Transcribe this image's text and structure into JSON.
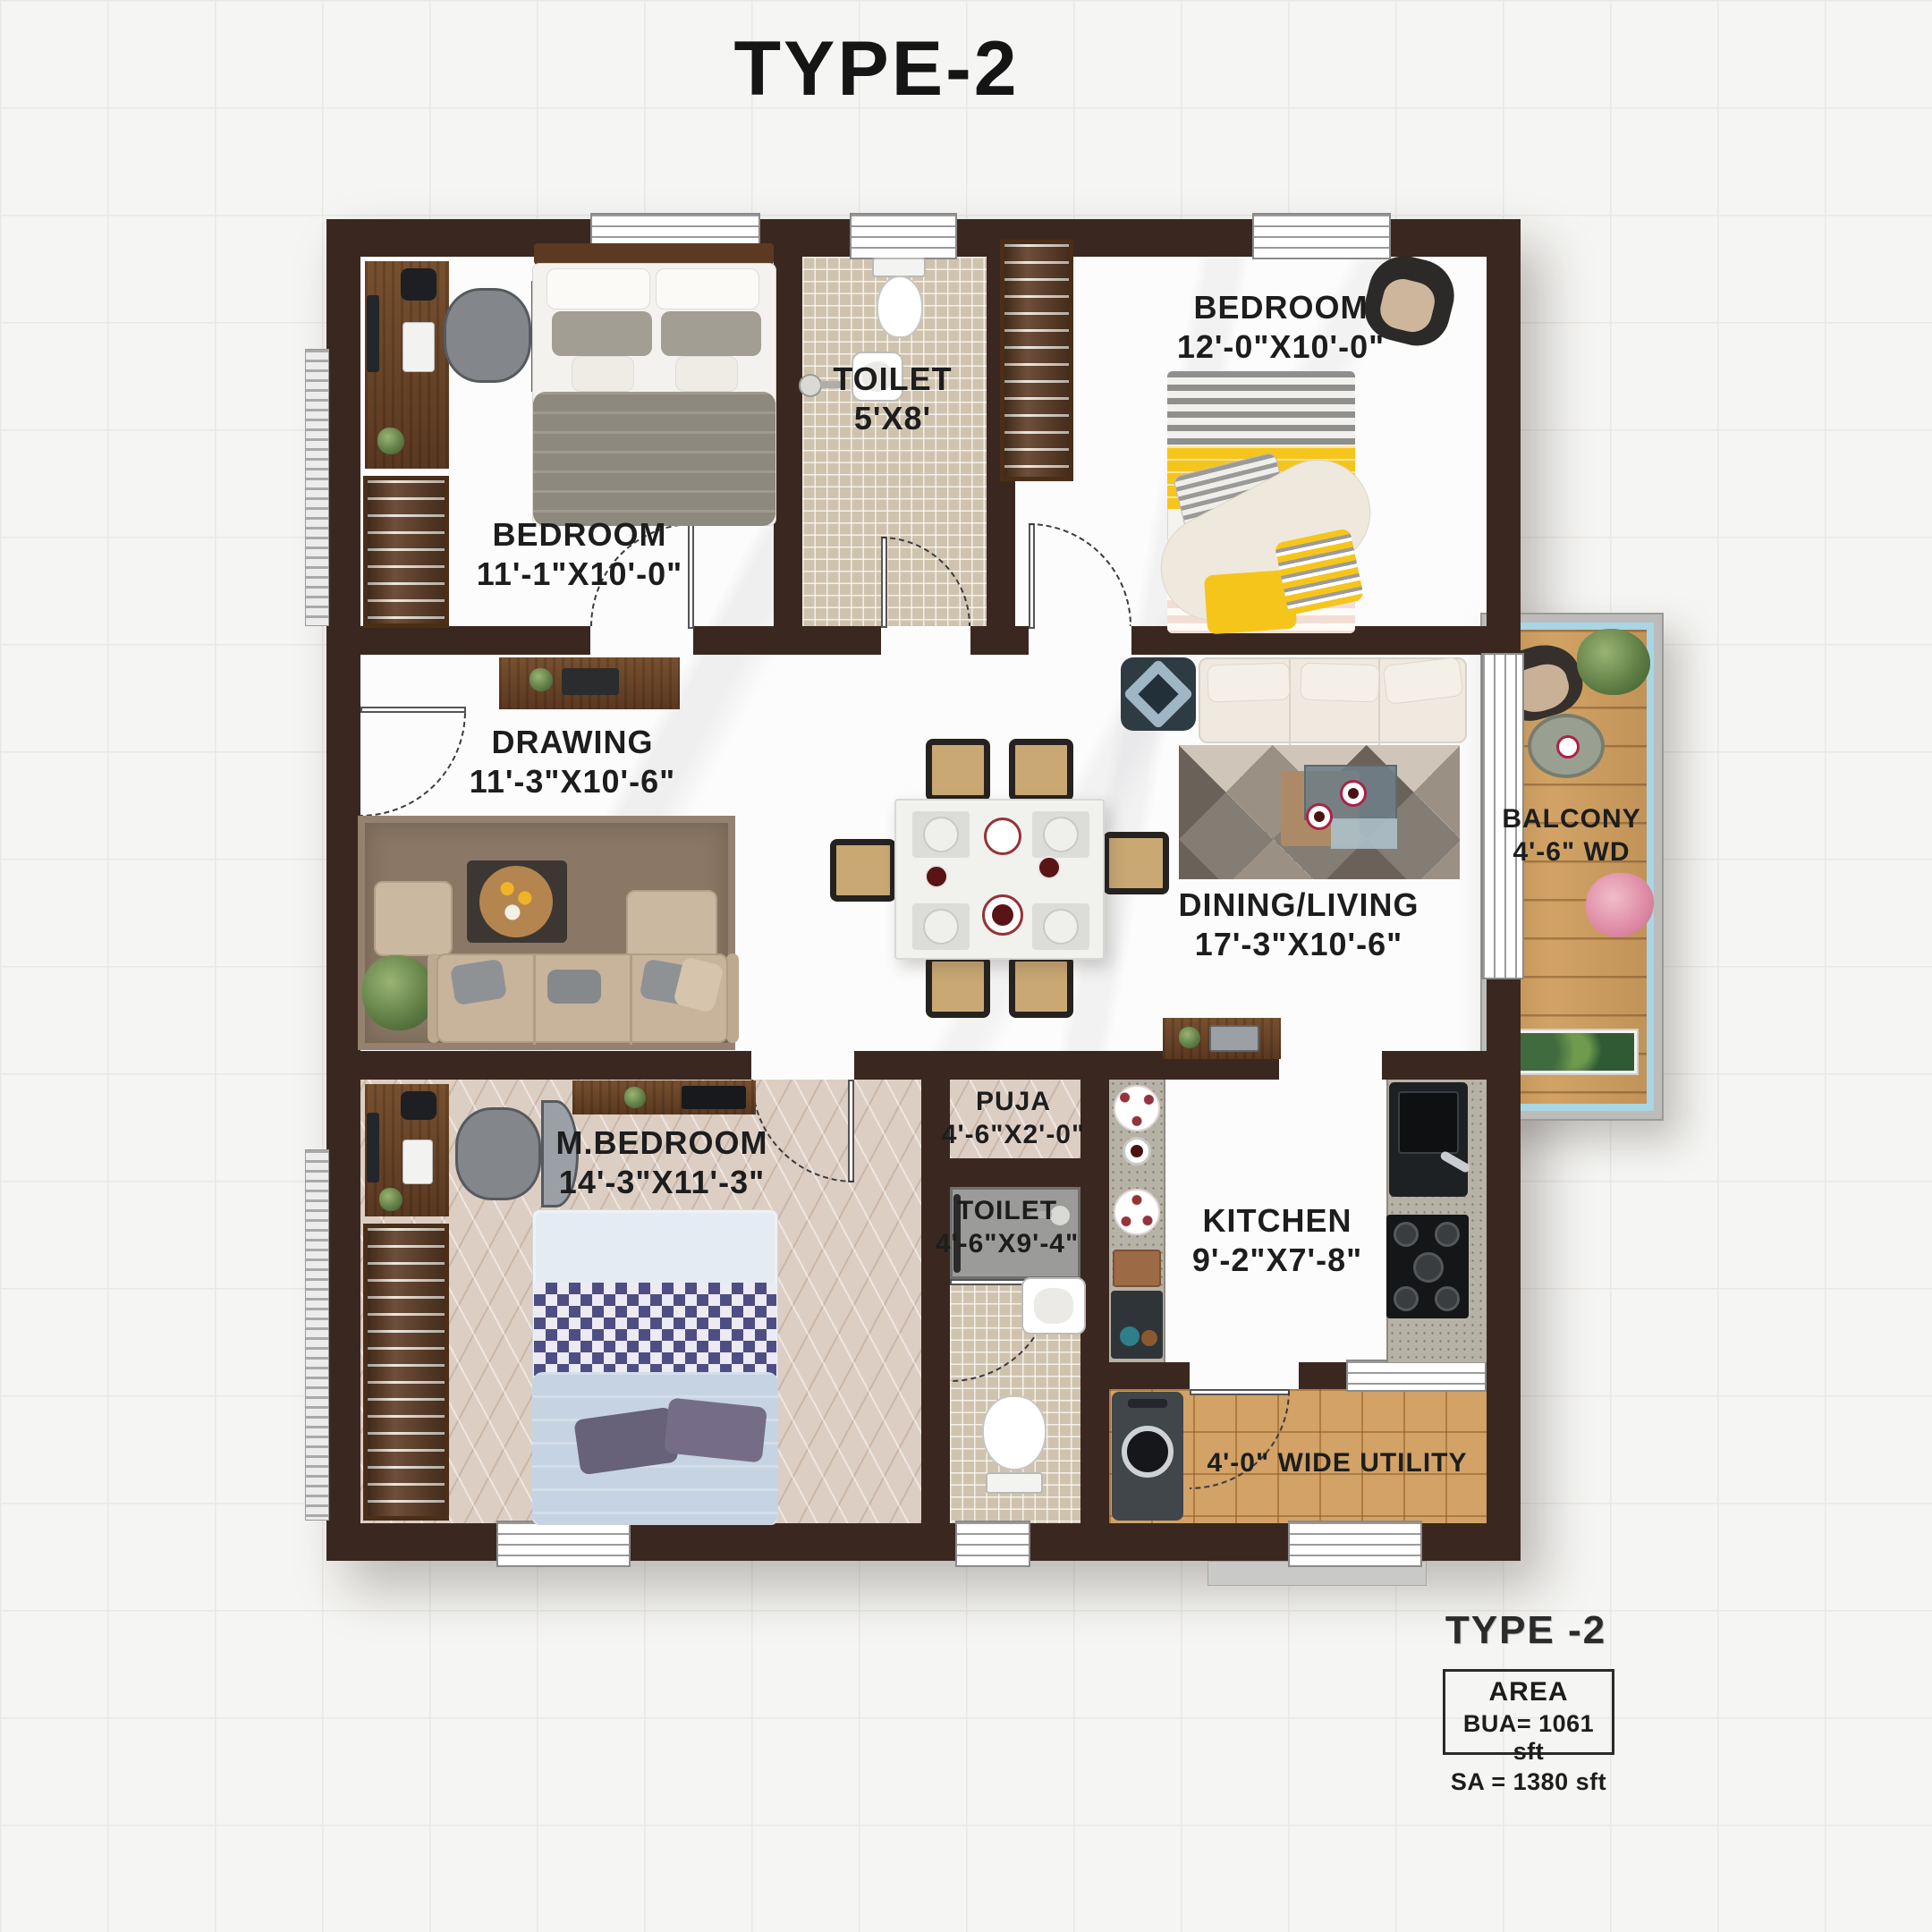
{
  "title": "TYPE-2",
  "rooms": {
    "bedroom_top_left": {
      "label": "BEDROOM",
      "dims": "11'-1\"X10'-0\""
    },
    "toilet_top": {
      "label": "TOILET",
      "dims": "5'X8'"
    },
    "bedroom_top_right": {
      "label": "BEDROOM",
      "dims": "12'-0\"X10'-0\""
    },
    "drawing": {
      "label": "DRAWING",
      "dims": "11'-3\"X10'-6\""
    },
    "dining_living": {
      "label": "DINING/LIVING",
      "dims": "17'-3\"X10'-6\""
    },
    "balcony": {
      "label": "BALCONY",
      "dims": "4'-6\" WD"
    },
    "master_bedroom": {
      "label": "M.BEDROOM",
      "dims": "14'-3\"X11'-3\""
    },
    "puja": {
      "label": "PUJA",
      "dims": "4'-6\"X2'-0\""
    },
    "toilet_bottom": {
      "label": "TOILET",
      "dims": "4'-6\"X9'-4\""
    },
    "kitchen": {
      "label": "KITCHEN",
      "dims": "9'-2\"X7'-8\""
    },
    "utility": {
      "label": "4'-0\" WIDE UTILITY"
    }
  },
  "legend": {
    "type_label": "TYPE  -2",
    "area_heading": "AREA",
    "bua": "BUA=  1061 sft",
    "sa": "SA  =  1380 sft"
  },
  "colors": {
    "wall": "#3a2820",
    "balcony_trim_blue": "#a9d6e5",
    "balcony_wood": "#d2a365",
    "utility_tile": "#d2a266",
    "bedding_yellow": "#f6c51c",
    "bedding_gray": "#8e897e",
    "bedding_blue_check": "#4e4e84"
  }
}
